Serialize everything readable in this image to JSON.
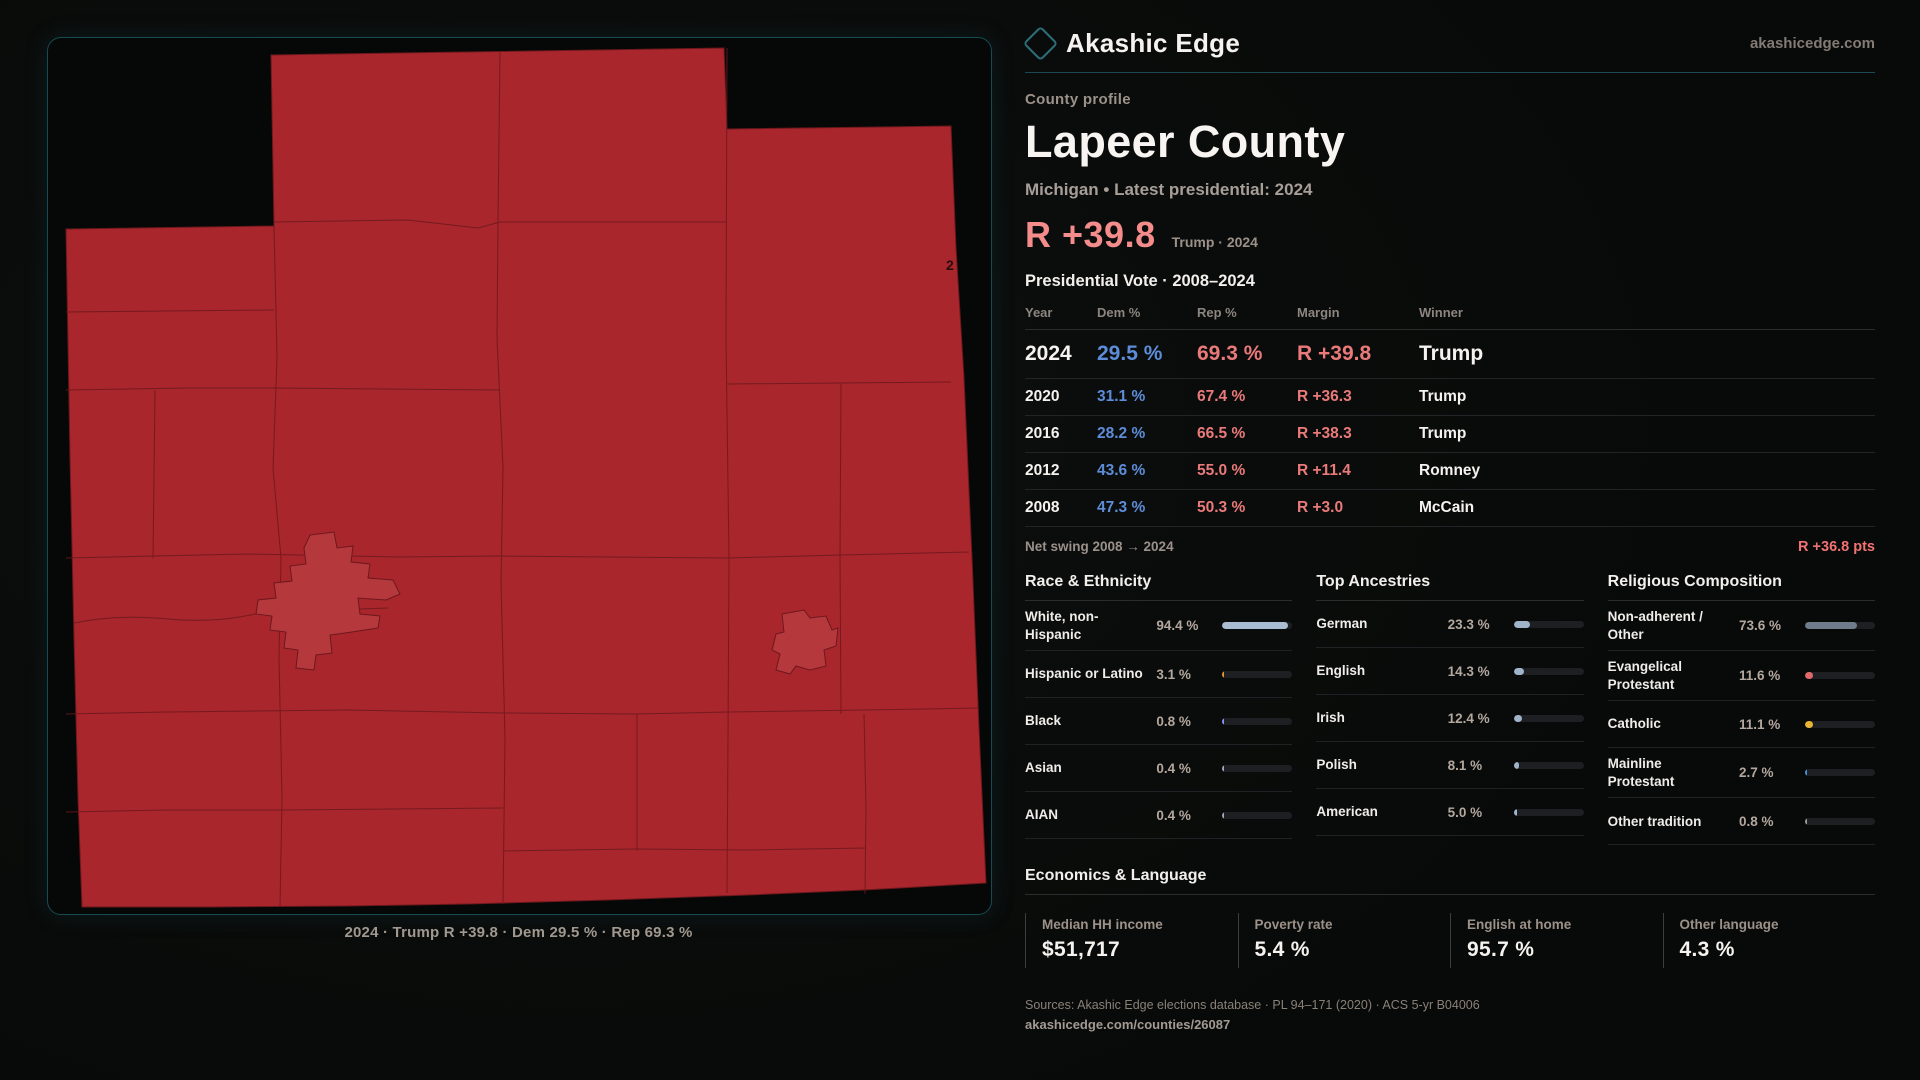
{
  "brand": {
    "name": "Akashic Edge",
    "domain": "akashicedge.com",
    "accent_teal": "#2b6e78"
  },
  "header": {
    "eyebrow": "County profile",
    "title": "Lapeer County",
    "subtitle": "Michigan • Latest presidential: 2024"
  },
  "margin_callout": {
    "value": "R +39.8",
    "context": "Trump · 2024",
    "color": "#f58c8c"
  },
  "vote_table": {
    "title": "Presidential Vote · 2008–2024",
    "columns": {
      "year": "Year",
      "dem": "Dem %",
      "rep": "Rep %",
      "margin": "Margin",
      "winner": "Winner"
    },
    "rows": [
      {
        "year": "2024",
        "dem": "29.5 %",
        "rep": "69.3 %",
        "margin": "R +39.8",
        "winner": "Trump",
        "highlight": true
      },
      {
        "year": "2020",
        "dem": "31.1 %",
        "rep": "67.4 %",
        "margin": "R +36.3",
        "winner": "Trump",
        "highlight": false
      },
      {
        "year": "2016",
        "dem": "28.2 %",
        "rep": "66.5 %",
        "margin": "R +38.3",
        "winner": "Trump",
        "highlight": false
      },
      {
        "year": "2012",
        "dem": "43.6 %",
        "rep": "55.0 %",
        "margin": "R +11.4",
        "winner": "Romney",
        "highlight": false
      },
      {
        "year": "2008",
        "dem": "47.3 %",
        "rep": "50.3 %",
        "margin": "R +3.0",
        "winner": "McCain",
        "highlight": false
      }
    ],
    "dem_color": "#5d8dd8",
    "rep_color": "#ea7a7a",
    "net_swing_label": "Net swing 2008 → 2024",
    "net_swing_value": "R +36.8 pts"
  },
  "demographics": [
    {
      "id": "race",
      "title": "Race & Ethnicity",
      "rows": [
        {
          "label": "White, non-Hispanic",
          "value": "94.4 %",
          "pct": 94.4,
          "color": "#a9bcd1"
        },
        {
          "label": "Hispanic or Latino",
          "value": "3.1 %",
          "pct": 3.1,
          "color": "#e8962e"
        },
        {
          "label": "Black",
          "value": "0.8 %",
          "pct": 0.8,
          "color": "#8b93f0"
        },
        {
          "label": "Asian",
          "value": "0.4 %",
          "pct": 0.4,
          "color": "#9aa8b8"
        },
        {
          "label": "AIAN",
          "value": "0.4 %",
          "pct": 0.4,
          "color": "#9aa8b8"
        }
      ]
    },
    {
      "id": "ancestries",
      "title": "Top Ancestries",
      "rows": [
        {
          "label": "German",
          "value": "23.3 %",
          "pct": 23.3,
          "color": "#9fb4c8"
        },
        {
          "label": "English",
          "value": "14.3 %",
          "pct": 14.3,
          "color": "#9fb4c8"
        },
        {
          "label": "Irish",
          "value": "12.4 %",
          "pct": 12.4,
          "color": "#9fb4c8"
        },
        {
          "label": "Polish",
          "value": "8.1 %",
          "pct": 8.1,
          "color": "#9fb4c8"
        },
        {
          "label": "American",
          "value": "5.0 %",
          "pct": 5.0,
          "color": "#9fb4c8"
        }
      ]
    },
    {
      "id": "religion",
      "title": "Religious Composition",
      "rows": [
        {
          "label": "Non-adherent / Other",
          "value": "73.6 %",
          "pct": 73.6,
          "color": "#6e7c8c"
        },
        {
          "label": "Evangelical Protestant",
          "value": "11.6 %",
          "pct": 11.6,
          "color": "#e06a6a"
        },
        {
          "label": "Catholic",
          "value": "11.1 %",
          "pct": 11.1,
          "color": "#e8b435"
        },
        {
          "label": "Mainline Protestant",
          "value": "2.7 %",
          "pct": 2.7,
          "color": "#4a8fd4"
        },
        {
          "label": "Other tradition",
          "value": "0.8 %",
          "pct": 0.8,
          "color": "#9a9a9a"
        }
      ]
    }
  ],
  "economics": {
    "title": "Economics & Language",
    "stats": [
      {
        "label": "Median HH income",
        "value": "$51,717"
      },
      {
        "label": "Poverty rate",
        "value": "5.4 %"
      },
      {
        "label": "English at home",
        "value": "95.7 %"
      },
      {
        "label": "Other language",
        "value": "4.3 %"
      }
    ]
  },
  "footer": {
    "sources": "Sources: Akashic Edge elections database · PL 94–171 (2020) · ACS 5-yr B04006",
    "permalink": "akashicedge.com/counties/26087"
  },
  "map": {
    "caption": "2024 · Trump R +39.8 · Dem 29.5 % · Rep 69.3 %",
    "stray_label": "2",
    "county_fill": "#a8262c",
    "city_fill": "#b5383d",
    "boundary_stroke": "#6d181d"
  }
}
